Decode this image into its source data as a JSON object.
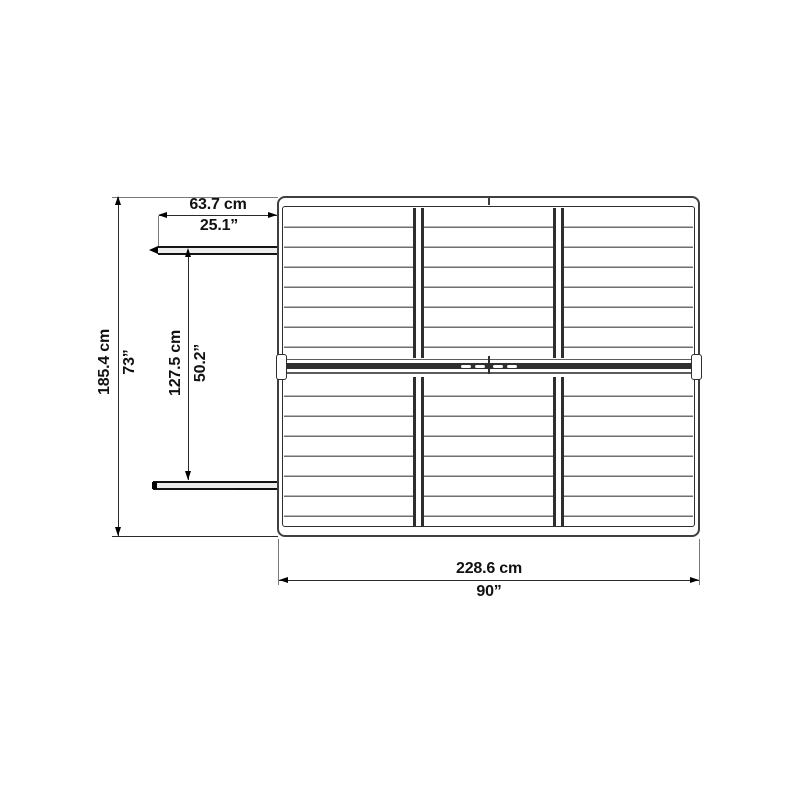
{
  "page": {
    "background_color": "#ffffff"
  },
  "structure": {
    "view": "top",
    "panel_columns": 3,
    "panel_rows": 2
  },
  "colors": {
    "frame": "#3f3f3f",
    "line": "#2a2a2a",
    "slat": "#6f6f6f",
    "ridge_band": "#2f2f2f",
    "text": "#111111",
    "background": "#ffffff"
  },
  "dimensions": {
    "overall_width": {
      "cm": "228.6 cm",
      "inches": "90”"
    },
    "overall_depth": {
      "cm": "185.4 cm",
      "inches": "73”"
    },
    "door_width": {
      "cm": "63.7 cm",
      "inches": "25.1”"
    },
    "door_opening_depth": {
      "cm": "127.5 cm",
      "inches": "50.2”"
    }
  }
}
